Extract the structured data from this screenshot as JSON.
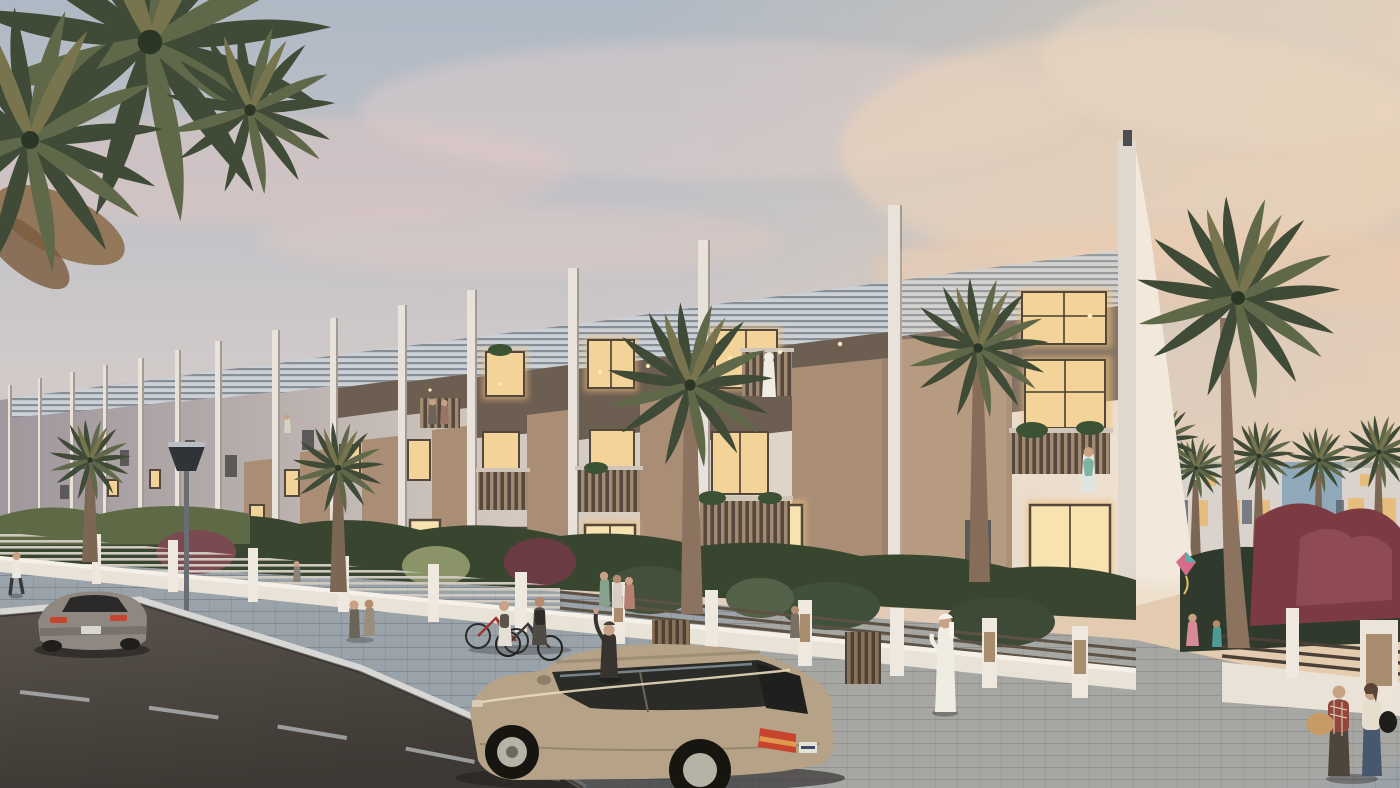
{
  "meta": {
    "type": "architectural-render",
    "setting": "Row of modern three-storey townhouses on a palm-lined street at dusk",
    "size": "1400x788"
  },
  "scene": {
    "description": "Dusk architectural rendering of a long row of modern white townhouses with louvered roof parapets, vertical fins, tan stone feature panels and warmly lit windows. A paver sidewalk with low white garden walls, slat fences, palms and a street lamp runs in front. A champagne SUV is parked at the curb, a grey sports car drives on the dark asphalt road, and pedestrians (a jogger, cyclists, a waving man in a suit, a man in a white kandura, couples and children) populate the scene. Distant lit villas, palm trees and a red-leafed tree close the right side under a pink-peach sunset sky.",
    "people_visible": 19,
    "cars": 2,
    "bicycles": 2,
    "street_lamps": 1
  },
  "palette": {
    "sky_top": "#aeb9c5",
    "sky_mid": "#d4cbc9",
    "sky_warm": "#ecd6bd",
    "cloud_pink": "#e3c6c0",
    "facade_light": "#e9dfd2",
    "facade_shadow": "#b3aaa8",
    "fin_white": "#e8e2da",
    "louver_bg": "#ccd1d6",
    "louver_grey": "#868f97",
    "panel_tan": "#bb9f86",
    "recess_shadow": "#6d5e52",
    "window_glow": "#f3d398",
    "window_bright": "#f8e2af",
    "window_frame": "#54483c",
    "window_dark": "#5b5a58",
    "wall_white": "#e9e2d7",
    "fence_rail": "#5d5244",
    "gate_wood": "#8a7258",
    "hedge_green": "#39462f",
    "bush_light": "#5d6a45",
    "red_foliage": "#7c3b42",
    "palm_green": "#3f4b36",
    "palm_trunk": "#8b7360",
    "grass_green": "#5c6a44",
    "distant_house": "#d9d3cb",
    "distant_blue_glass": "#8fa9bb",
    "sidewalk_paver": "#9aa2aa",
    "curb": "#d7d8d5",
    "road_asphalt": "#4a443f",
    "lane_marking": "#cbd0d2",
    "suv_body": "#b5a287",
    "suv_glass": "#2b2b28",
    "sportscar_body": "#8e8881",
    "taillight_red": "#c8442e",
    "lamp_post": "#6a6e72",
    "kandura_white": "#efece4",
    "suit_dark": "#37332f",
    "skin": "#c9a184"
  }
}
